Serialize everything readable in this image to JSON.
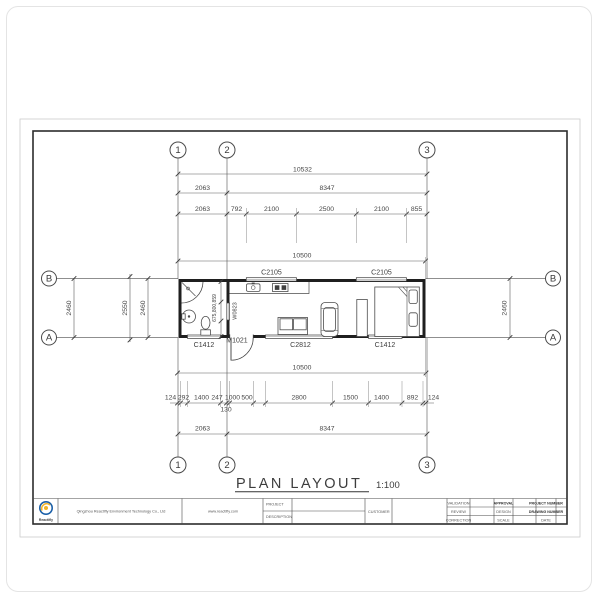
{
  "sheet": {
    "title": "PLAN LAYOUT",
    "scale": "1:100"
  },
  "grid": {
    "c1": "1",
    "c2": "2",
    "c3": "3",
    "rowB": "B",
    "rowA": "A"
  },
  "dims": {
    "top_total": "10532",
    "top_r2": [
      "2063",
      "8347"
    ],
    "top_r3": [
      "2063",
      "792",
      "2100",
      "2500",
      "2100",
      "855"
    ],
    "plan_width_top": "10500",
    "left_outer": "2460",
    "left_mid": "2550",
    "left_inner": "2460",
    "right": "2460",
    "bath_chain": "675,800,859",
    "plan_width_bottom": "10500",
    "bot_chain": [
      "124",
      "292",
      "1400",
      "247",
      "1000",
      "500",
      "2800",
      "1500",
      "1400",
      "892",
      "124"
    ],
    "bot_chain_below": "130",
    "bot_r2": [
      "2063",
      "8347"
    ]
  },
  "labels": {
    "window_top_left": "C2105",
    "window_top_right": "C2105",
    "window_interior": "W0823",
    "window_bath": "C1412",
    "door_main": "M1021",
    "window_living": "C2812",
    "window_bedroom": "C1412"
  },
  "titleblock": {
    "company": "Qingzhou Reactifly Environment Technology Co., Ltd",
    "website": "www.reactifly.com",
    "logo_text": "Reactifly",
    "project": "PROJECT",
    "description": "DESCRIPTION",
    "customer": "CUSTOMER",
    "validation": "VALIDATION",
    "review": "REVIEW",
    "correction": "CORRECTION",
    "approval": "APPROVAL",
    "design": "DESIGN",
    "scale": "SCALE",
    "project_number": "PROJECT NUMBER",
    "drawing_number": "DRAWING NUMBER",
    "date": "DATE"
  }
}
